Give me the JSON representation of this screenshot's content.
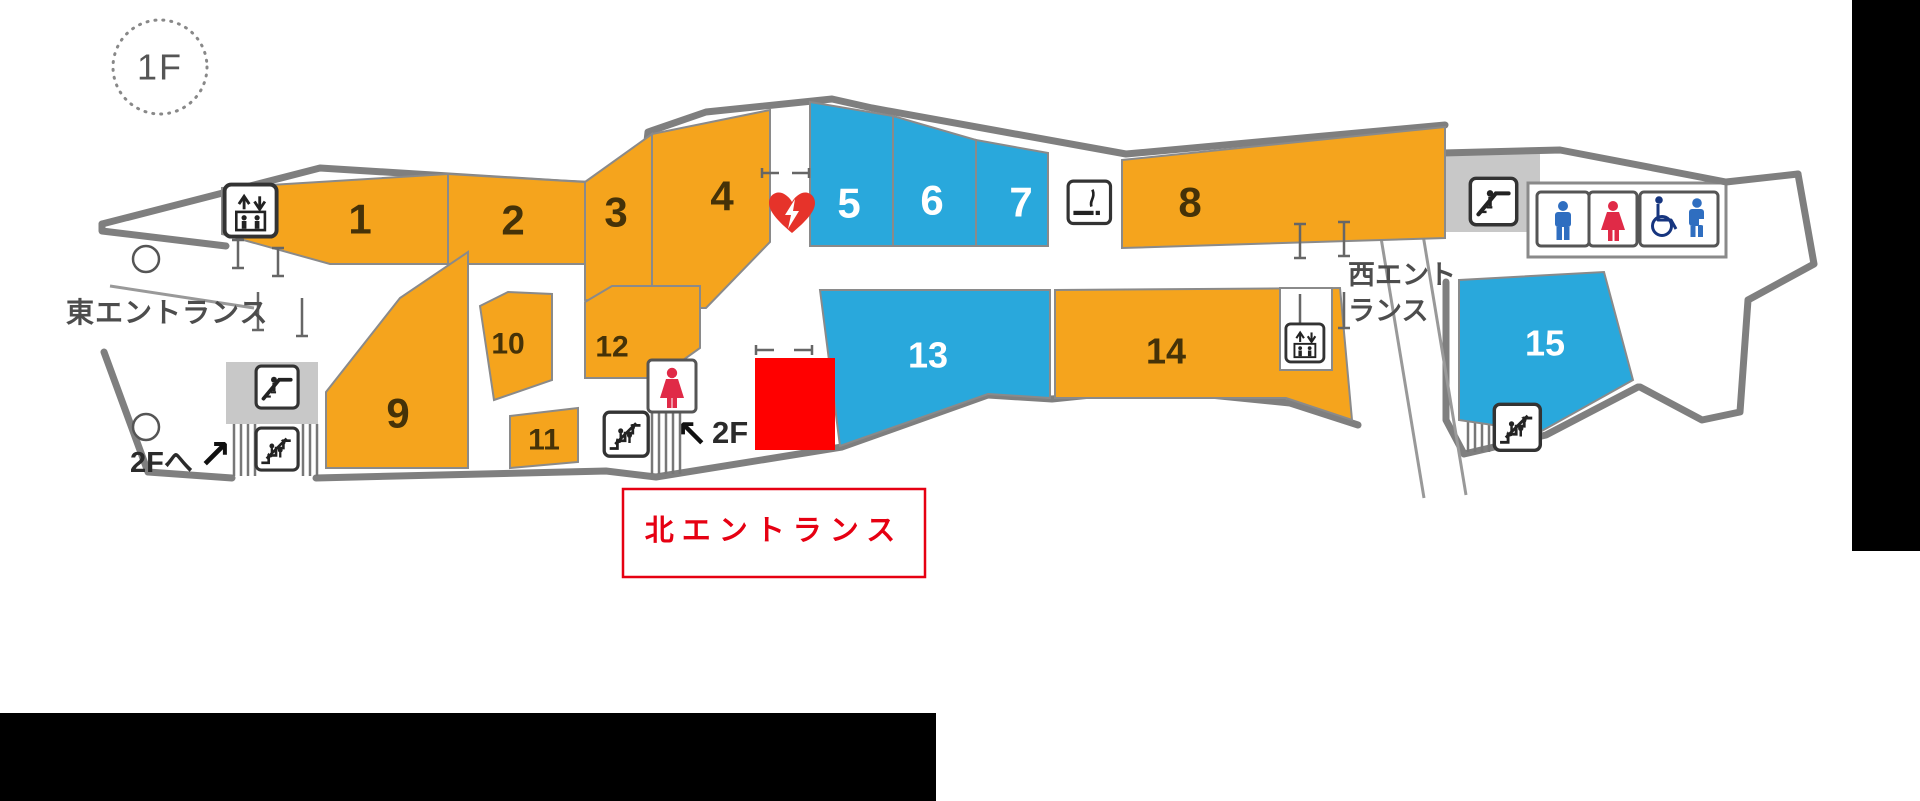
{
  "floor_badge": {
    "label": "1F"
  },
  "map": {
    "zones": [
      {
        "number": "1",
        "color": "orange"
      },
      {
        "number": "2",
        "color": "orange"
      },
      {
        "number": "3",
        "color": "orange"
      },
      {
        "number": "4",
        "color": "orange"
      },
      {
        "number": "5",
        "color": "blue"
      },
      {
        "number": "6",
        "color": "blue"
      },
      {
        "number": "7",
        "color": "blue"
      },
      {
        "number": "8",
        "color": "orange"
      },
      {
        "number": "9",
        "color": "orange"
      },
      {
        "number": "10",
        "color": "orange"
      },
      {
        "number": "11",
        "color": "orange"
      },
      {
        "number": "12",
        "color": "orange"
      },
      {
        "number": "13",
        "color": "blue"
      },
      {
        "number": "14",
        "color": "orange"
      },
      {
        "number": "15",
        "color": "blue"
      }
    ],
    "entrances": {
      "east": {
        "label": "東エントランス"
      },
      "west": {
        "line1": "西エント",
        "line2": "ランス"
      },
      "north": {
        "label": "北エントランス"
      }
    },
    "annotations": {
      "to_2f_left": {
        "label": "2Fへ",
        "arrow": "↗"
      },
      "to_2f_center": {
        "label": "2F",
        "arrow": "↖"
      }
    },
    "icons": [
      {
        "name": "elevator-icon",
        "meaning": "elevator"
      },
      {
        "name": "escalator-icon",
        "meaning": "escalator"
      },
      {
        "name": "stairs-icon",
        "meaning": "stairs"
      },
      {
        "name": "aed-heart-icon",
        "meaning": "AED"
      },
      {
        "name": "smoking-area-icon",
        "meaning": "smoking area"
      },
      {
        "name": "mens-toilet-icon",
        "meaning": "men's toilet"
      },
      {
        "name": "womens-toilet-icon",
        "meaning": "women's toilet"
      },
      {
        "name": "accessible-toilet-icon",
        "meaning": "accessible toilet"
      }
    ],
    "highlight": {
      "type": "red-square-marker"
    },
    "colors": {
      "zone_orange": "#F5A41D",
      "zone_blue": "#29A8DC",
      "outline_gray": "#7F7F7F",
      "number_dark": "#453208",
      "number_light": "#FFFFFF",
      "entrance_text": "#4D4D4D",
      "north_entrance_red": "#E60012",
      "highlight_red": "#FF0000",
      "aed_red": "#E6332A",
      "male_blue": "#2F6EC0",
      "female_red": "#E02A47",
      "accessible_navy": "#16357F",
      "mask_black": "#000000"
    }
  }
}
